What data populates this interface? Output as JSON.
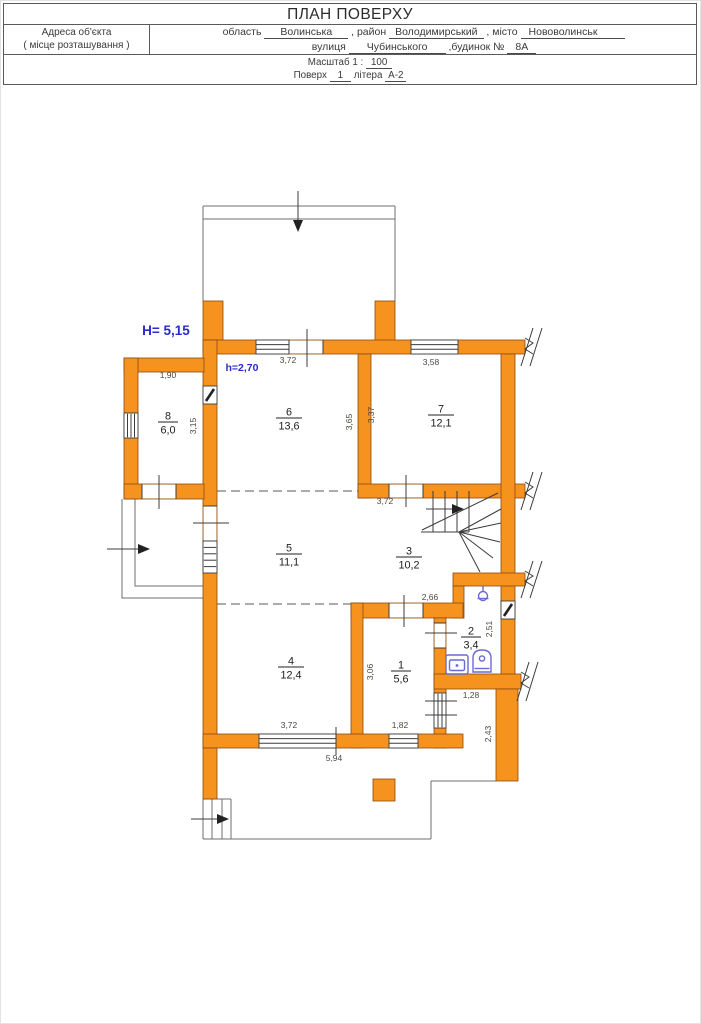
{
  "header": {
    "title": "ПЛАН ПОВЕРХУ",
    "address_label_line1": "Адреса об'єкта",
    "address_label_line2": "( місце розташування )",
    "region_label": "область",
    "region_value": "Волинська",
    "district_label": ", район",
    "district_value": "Володимирський",
    "city_label": ", місто",
    "city_value": "Нововолинськ",
    "street_label": "вулиця",
    "street_value": "Чубинського",
    "building_label": ",будинок №",
    "building_value": "8А",
    "scale_label": "Масштаб 1 :",
    "scale_value": "100",
    "floor_label": "Поверх",
    "floor_value": "1",
    "letter_label": "літера",
    "letter_value": "А-2"
  },
  "annotations": {
    "building_height": "H= 5,15",
    "ceiling_height": "h=2,70"
  },
  "rooms": [
    {
      "number": "1",
      "area": "5,6"
    },
    {
      "number": "2",
      "area": "3,4"
    },
    {
      "number": "3",
      "area": "10,2"
    },
    {
      "number": "4",
      "area": "12,4"
    },
    {
      "number": "5",
      "area": "11,1"
    },
    {
      "number": "6",
      "area": "13,6"
    },
    {
      "number": "7",
      "area": "12,1"
    },
    {
      "number": "8",
      "area": "6,0"
    }
  ],
  "dimensions": {
    "room8_width": "1,90",
    "room8_depth": "3,15",
    "room6_top": "3,72",
    "room6_depth": "3,65",
    "room7_top": "3,58",
    "room7_depth": "3,37",
    "hall_top": "3,72",
    "hall_passage": "2,66",
    "bath_depth": "2,51",
    "corridor_depth": "3,06",
    "nook_width": "1,28",
    "room4_window": "3,72",
    "room1_window": "1,82",
    "terrace_width": "5,94",
    "terrace_side": "2,43"
  },
  "icons": {
    "lamp": "pendant-lamp-icon",
    "sink": "washbasin-icon",
    "toilet": "toilet-icon",
    "entry_arrows": "entrance-arrow-icon"
  },
  "colors": {
    "wall": "#F6921E",
    "annotation_blue": "#2B2BC8",
    "fixture_blue": "#6A6AD4"
  }
}
